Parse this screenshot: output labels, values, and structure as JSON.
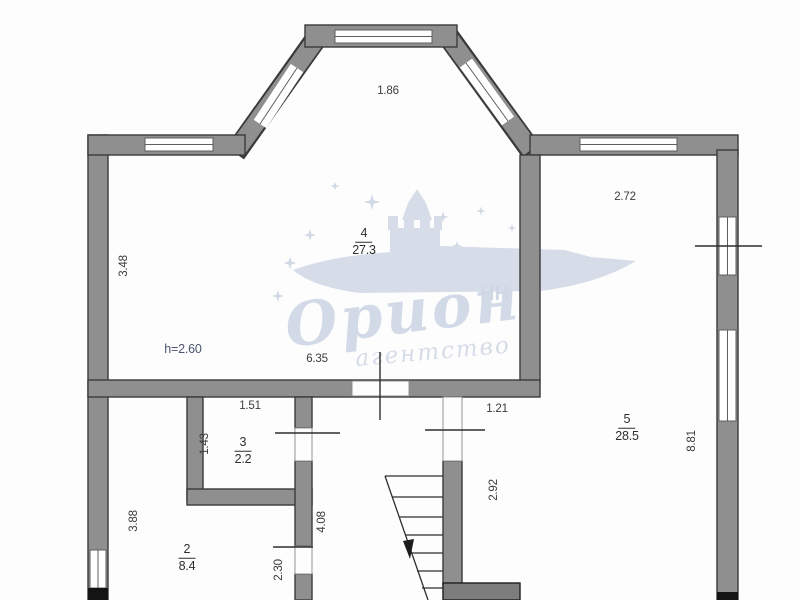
{
  "plan": {
    "rooms": [
      {
        "number": "4",
        "area": "27.3"
      },
      {
        "number": "5",
        "area": "28.5"
      },
      {
        "number": "3",
        "area": "2.2"
      },
      {
        "number": "2",
        "area": "8.4"
      }
    ],
    "dimensions": {
      "bay_top": "1.86",
      "right_wing_top": "2.72",
      "left_wall_upper": "3.48",
      "ceiling_height": "h=2.60",
      "room4_bottom": "6.35",
      "room3_width": "1.51",
      "room3_height": "1.43",
      "room5_door": "1.21",
      "room5_inner": "2.92",
      "right_wall_lower": "8.81",
      "room2_left": "3.88",
      "room2_door": "2.30",
      "hall_height": "4.08"
    }
  },
  "watermark": {
    "brand": "Орион",
    "region": "НН",
    "subtitle": "агентство"
  },
  "colors": {
    "wall_fill": "#8f8f8f",
    "wall_edge": "#3a3a3a",
    "dimension_text": "#3c3c3c",
    "height_text": "#4a5570",
    "watermark": "#cbd4e3"
  }
}
